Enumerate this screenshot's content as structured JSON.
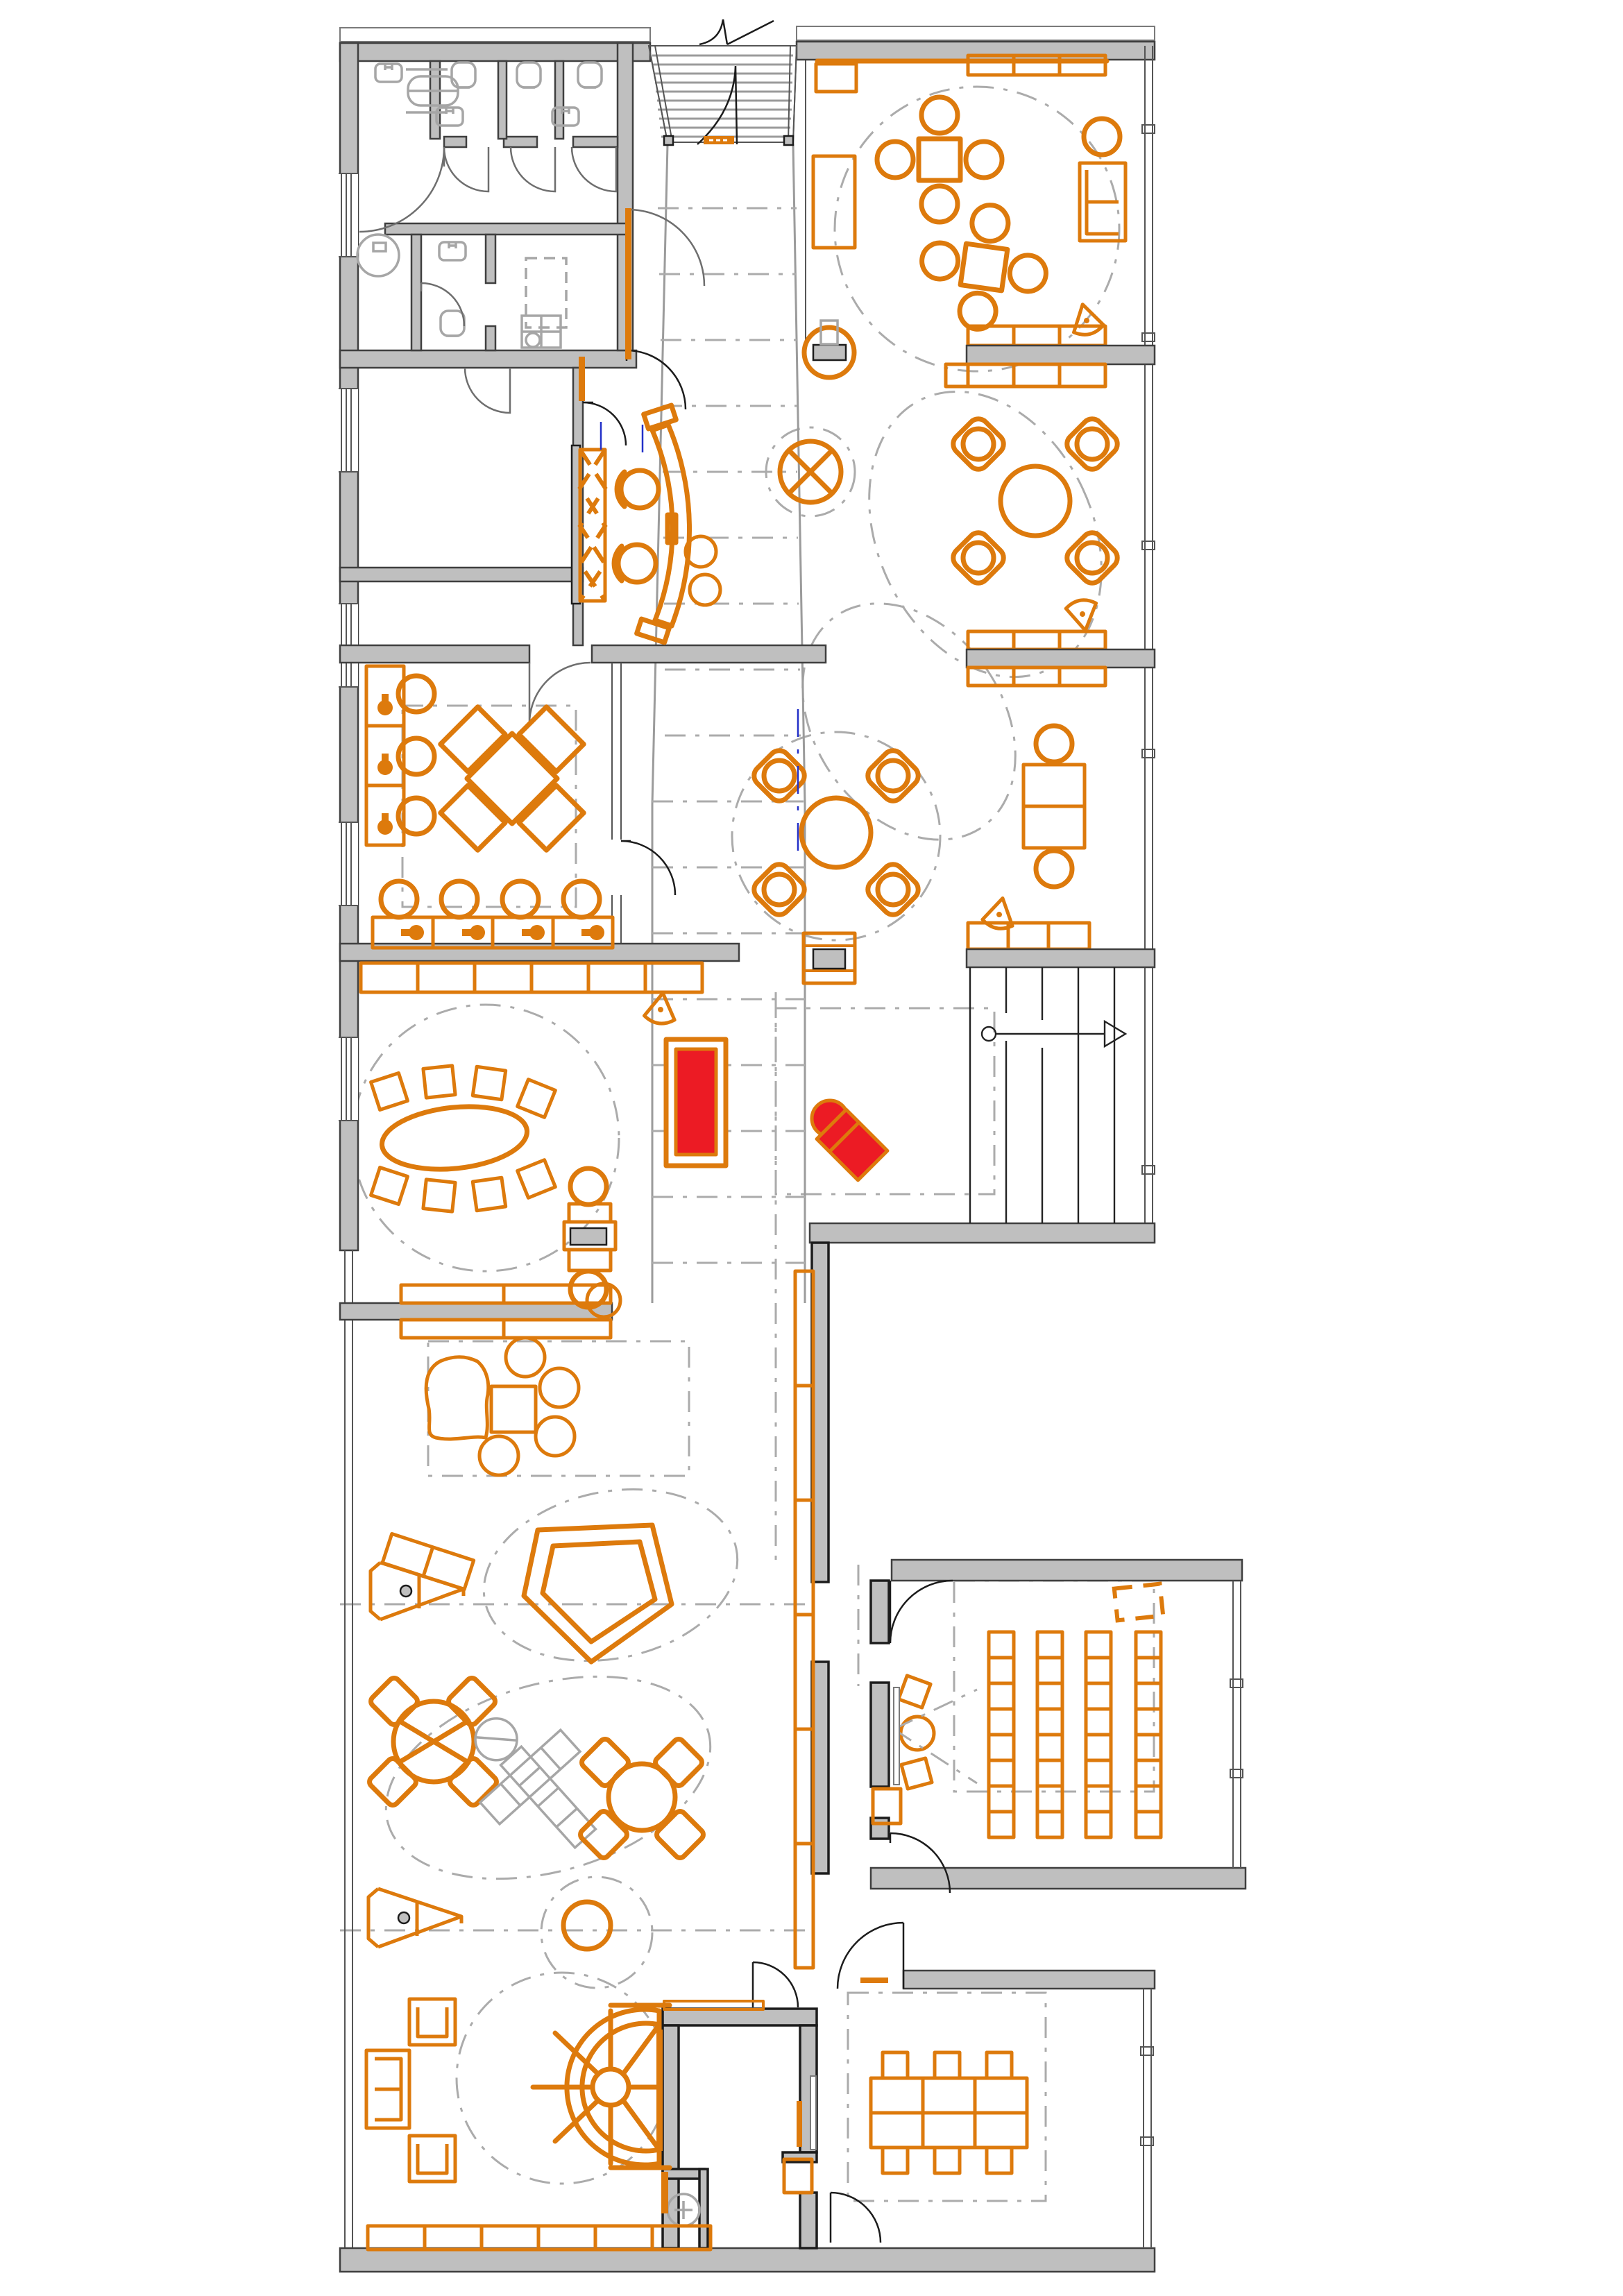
{
  "meta": {
    "title": "Library first-floor furniture plan",
    "drawing_type": "architectural floor plan, no text labels visible"
  },
  "colors": {
    "furniture_orange": "#DD7A0C",
    "highlight_red": "#EC1B24",
    "wall_gray": "#BFBFBF",
    "fixture_gray": "#A6A6A6",
    "zone_dash_gray": "#ABABAB",
    "line_black": "#1C1C1C",
    "door_gray": "#6E6E6E",
    "glazing_gray": "#555555",
    "grid_blue": "#2330C8",
    "background": "#FFFFFF"
  },
  "areas": [
    "entrance-ramp-top-center",
    "wc-block-top-left",
    "storage-rooms-left",
    "reception-with-curved-desk",
    "central-ramp-corridor",
    "reading-room-top-right",
    "lounge-zones-right",
    "workroom-with-x-table-left",
    "oval-meeting-zone",
    "red-reading-corner",
    "straight-stair-right",
    "open-childrens-area-bottom-left",
    "classroom-bottom-right-wing",
    "spiral-amphitheater-bottom-left",
    "storage-wc-bottom-center",
    "meeting-room-bottom-right"
  ],
  "inventory": {
    "square_tables_with_4_round_chairs": 2,
    "diamond_chair_clusters_with_round_table": 2,
    "kids_round_tables_with_diamond_chairs": 2,
    "oval_table_with_8_chairs": 1,
    "x_shaped_table_group": 1,
    "wall_desks_with_task_chairs": 7,
    "tutor_desk_with_2_chairs": 1,
    "media_desks_with_screen": 2,
    "curved_reception_desk": 1,
    "classroom_chair_rows": 4,
    "classroom_chairs_total": 32,
    "meeting_table_modules": 6,
    "meeting_chairs": 6,
    "sofas": 3,
    "armchairs": 2,
    "organic_sofa": 1,
    "poufs": 6,
    "play_easels": 2,
    "pentagon_play_house": 1,
    "play_plane_structure": 1,
    "triangle_play_stools": 4,
    "red_rug": 1,
    "red_pouf": 1,
    "red_lounge_chair": 1,
    "straight_stairs": 2,
    "entrance_ramp": 1,
    "spiral_amphitheater": 1,
    "wc_toilets": 6,
    "wc_sinks": 6,
    "shelf_runs": 14
  }
}
